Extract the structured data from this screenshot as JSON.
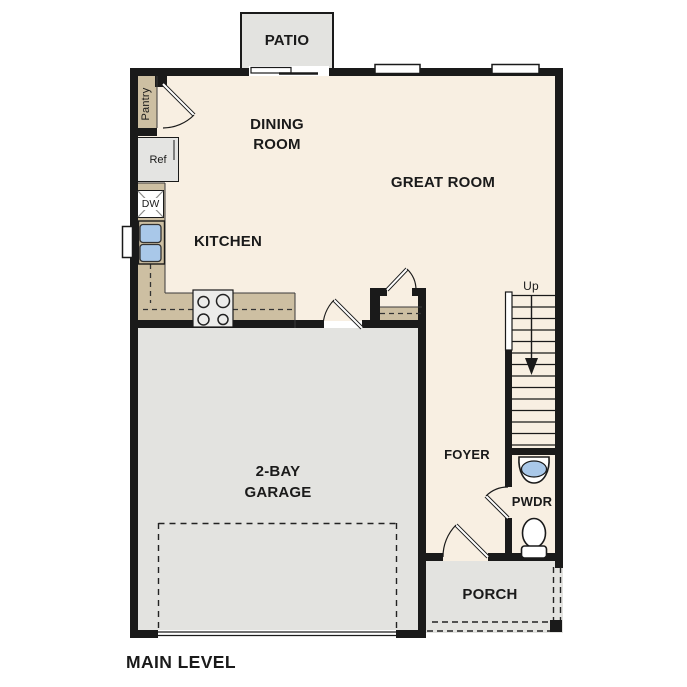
{
  "plan": {
    "title": "MAIN LEVEL",
    "rooms": {
      "patio": "PATIO",
      "dining": "DINING ROOM",
      "great": "GREAT ROOM",
      "kitchen": "KITCHEN",
      "garage": "2-BAY GARAGE",
      "foyer": "FOYER",
      "powder": "PWDR",
      "porch": "PORCH",
      "pantry": "Pantry"
    },
    "stairs": {
      "direction_label": "Up"
    },
    "appliances": {
      "refrigerator": "Ref",
      "dishwasher": "DW"
    },
    "icons": [
      "kitchen-sink-icon",
      "cooktop-icon",
      "toilet-icon",
      "pedestal-sink-icon",
      "stairs-up-arrow-icon",
      "window-icon",
      "sliding-glass-door-icon",
      "door-swing-icon",
      "garage-door-icon",
      "porch-post-icon"
    ],
    "colors": {
      "wall": "#1a1a1a",
      "interior_floor": "#f8efe2",
      "outdoor_concrete": "#e3e3e0",
      "counter": "#cdbfa2",
      "water_fixture": "#a9c8e9"
    }
  }
}
